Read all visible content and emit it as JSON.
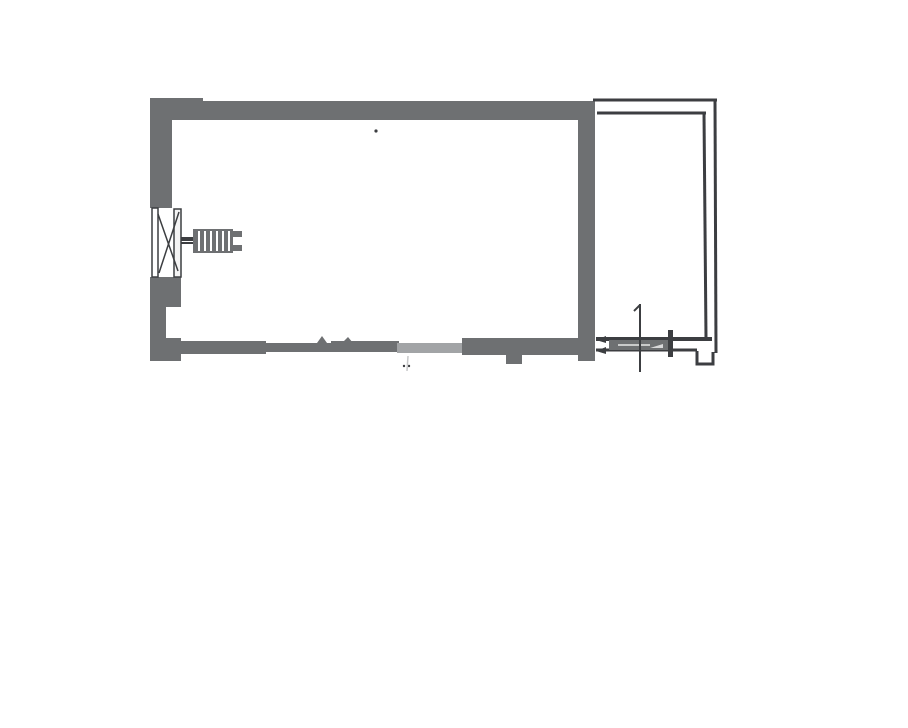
{
  "page": {
    "width": 908,
    "height": 728,
    "background": "#ffffff"
  },
  "drawing": {
    "kind": "scanned floor plan",
    "colors": {
      "wall": "#6e7072",
      "wall_faded": "#a2a4a6",
      "line": "#3c3e41",
      "paper": "#ffffff",
      "highlight": "#f4f4f4",
      "faint": "#c8c9ca"
    },
    "viewbox": "0 0 908 728",
    "elements": [
      {
        "name": "main-room-top-and-left-wall",
        "type": "path",
        "attrs": {
          "d": "M150 98 H203 V101 H594 V120 H172 V208 H150 Z",
          "fill": "@wall"
        }
      },
      {
        "name": "main-room-right-wall",
        "type": "rect",
        "attrs": {
          "x": 578,
          "y": 101,
          "width": 17,
          "height": 260,
          "fill": "@wall"
        }
      },
      {
        "name": "left-wall-below-window",
        "type": "path",
        "attrs": {
          "d": "M150 277 H181 V307 H166 V339 H150 Z",
          "fill": "@wall"
        }
      },
      {
        "name": "bottom-wall-left-segment",
        "type": "path",
        "attrs": {
          "d": "M150 338 H181 V341 H266 V354 H181 V361 H150 Z",
          "fill": "@wall"
        }
      },
      {
        "name": "bottom-wall-middle-segment",
        "type": "path",
        "attrs": {
          "d": "M266 343 H331 V341 H399 V352 H266 Z",
          "fill": "@wall"
        }
      },
      {
        "name": "bottom-wall-tick-1",
        "type": "path",
        "attrs": {
          "d": "M317 343 L322 336 L327 343 Z",
          "fill": "@wall"
        }
      },
      {
        "name": "bottom-wall-tick-2",
        "type": "path",
        "attrs": {
          "d": "M342 343 L348 337 L353 343 Z",
          "fill": "@wall"
        }
      },
      {
        "name": "bottom-wall-faded-segment",
        "type": "rect",
        "attrs": {
          "x": 397,
          "y": 343,
          "width": 68,
          "height": 10,
          "fill": "@wall_faded"
        }
      },
      {
        "name": "bottom-wall-right-segment",
        "type": "path",
        "attrs": {
          "d": "M462 338 H578 V355 H522 V364 H506 V355 H462 Z",
          "fill": "@wall"
        }
      },
      {
        "name": "balcony-outer-top-line",
        "type": "line",
        "attrs": {
          "x1": 593,
          "y1": 100,
          "x2": 717,
          "y2": 100,
          "stroke": "@line",
          "stroke-width": 3
        }
      },
      {
        "name": "balcony-inner-top-line",
        "type": "line",
        "attrs": {
          "x1": 597,
          "y1": 113,
          "x2": 706,
          "y2": 113,
          "stroke": "@line",
          "stroke-width": 3
        }
      },
      {
        "name": "balcony-inner-right-line",
        "type": "line",
        "attrs": {
          "x1": 704,
          "y1": 113,
          "x2": 706,
          "y2": 338,
          "stroke": "@line",
          "stroke-width": 3
        }
      },
      {
        "name": "balcony-outer-right-line",
        "type": "line",
        "attrs": {
          "x1": 715,
          "y1": 100,
          "x2": 716,
          "y2": 353,
          "stroke": "@line",
          "stroke-width": 3
        }
      },
      {
        "name": "balcony-bottom-outer-line",
        "type": "line",
        "attrs": {
          "x1": 596,
          "y1": 339,
          "x2": 712,
          "y2": 339,
          "stroke": "@line",
          "stroke-width": 4
        }
      },
      {
        "name": "balcony-bottom-inner-line",
        "type": "line",
        "attrs": {
          "x1": 596,
          "y1": 350,
          "x2": 697,
          "y2": 350,
          "stroke": "@line",
          "stroke-width": 3
        }
      },
      {
        "name": "balcony-corner-notch",
        "type": "path",
        "attrs": {
          "d": "M697 351 V364 H713 V352",
          "fill": "none",
          "stroke": "@line",
          "stroke-width": 3
        }
      },
      {
        "name": "door-leaf",
        "type": "rect",
        "attrs": {
          "x": 609,
          "y": 340,
          "width": 62,
          "height": 10,
          "fill": "@wall"
        }
      },
      {
        "name": "door-leaf-highlight",
        "type": "line",
        "attrs": {
          "x1": 618,
          "y1": 345,
          "x2": 650,
          "y2": 345,
          "stroke": "#fafafa",
          "stroke-width": 2,
          "opacity": 0.65
        }
      },
      {
        "name": "door-leaf-wedge",
        "type": "path",
        "attrs": {
          "d": "M650 348 L663 344 L663 348 Z",
          "fill": "#f2f2f2",
          "opacity": 0.8
        }
      },
      {
        "name": "door-stop-bar",
        "type": "rect",
        "attrs": {
          "x": 668,
          "y": 330,
          "width": 5,
          "height": 27,
          "fill": "@line"
        }
      },
      {
        "name": "door-axis-line",
        "type": "line",
        "attrs": {
          "x1": 640,
          "y1": 304,
          "x2": 640,
          "y2": 372,
          "stroke": "@line",
          "stroke-width": 2
        }
      },
      {
        "name": "door-axis-arrow",
        "type": "path",
        "attrs": {
          "d": "M640 305 L634 311",
          "fill": "none",
          "stroke": "@line",
          "stroke-width": 2
        }
      },
      {
        "name": "door-arrow-upper",
        "type": "path",
        "attrs": {
          "d": "M606 336 L596 340 L606 343 Z",
          "fill": "@line"
        }
      },
      {
        "name": "door-arrow-lower",
        "type": "path",
        "attrs": {
          "d": "M606 347 L596 351 L606 354 Z",
          "fill": "@line"
        }
      },
      {
        "name": "window-outer-bar",
        "type": "rect",
        "attrs": {
          "x": 152,
          "y": 208,
          "width": 6,
          "height": 69,
          "fill": "#ffffff",
          "stroke": "@line",
          "stroke-width": 1.5
        }
      },
      {
        "name": "window-inner-bar",
        "type": "rect",
        "attrs": {
          "x": 174,
          "y": 209,
          "width": 7,
          "height": 68,
          "fill": "@highlight",
          "stroke": "@line",
          "stroke-width": 1.5
        }
      },
      {
        "name": "window-diagonal-1",
        "type": "path",
        "attrs": {
          "d": "M179 212 L159 273",
          "fill": "none",
          "stroke": "@line",
          "stroke-width": 1.5
        }
      },
      {
        "name": "window-diagonal-2",
        "type": "path",
        "attrs": {
          "d": "M158 214 L178 271",
          "fill": "none",
          "stroke": "@line",
          "stroke-width": 1.5
        }
      },
      {
        "name": "window-sill-line-1",
        "type": "line",
        "attrs": {
          "x1": 181,
          "y1": 238,
          "x2": 194,
          "y2": 238,
          "stroke": "@line",
          "stroke-width": 2
        }
      },
      {
        "name": "window-sill-line-2",
        "type": "line",
        "attrs": {
          "x1": 181,
          "y1": 243,
          "x2": 194,
          "y2": 243,
          "stroke": "@line",
          "stroke-width": 2
        }
      },
      {
        "name": "radiator-icon-body",
        "type": "rect",
        "attrs": {
          "x": 193,
          "y": 229,
          "width": 40,
          "height": 24,
          "fill": "@wall"
        }
      },
      {
        "name": "radiator-icon-stripes",
        "type": "path",
        "attrs": {
          "d": "M199 231 V251 M205 231 V251 M211 231 V251 M217 231 V251 M223 231 V251 M229 231 V251",
          "fill": "none",
          "stroke": "#ffffff",
          "stroke-width": 2
        }
      },
      {
        "name": "radiator-icon-notch-top",
        "type": "rect",
        "attrs": {
          "x": 231,
          "y": 231,
          "width": 11,
          "height": 6,
          "fill": "@wall"
        }
      },
      {
        "name": "radiator-icon-notch-bottom",
        "type": "rect",
        "attrs": {
          "x": 231,
          "y": 245,
          "width": 11,
          "height": 6,
          "fill": "@wall"
        }
      },
      {
        "name": "radiator-connector-line",
        "type": "line",
        "attrs": {
          "x1": 181,
          "y1": 240,
          "x2": 193,
          "y2": 240,
          "stroke": "@line",
          "stroke-width": 2
        }
      },
      {
        "name": "scan-speck",
        "type": "circle",
        "attrs": {
          "cx": 376,
          "cy": 131,
          "r": 1.6,
          "fill": "@line"
        }
      },
      {
        "name": "scan-dot-1",
        "type": "circle",
        "attrs": {
          "cx": 404,
          "cy": 366,
          "r": 1.2,
          "fill": "@line"
        }
      },
      {
        "name": "scan-dot-2",
        "type": "circle",
        "attrs": {
          "cx": 409,
          "cy": 366,
          "r": 1.2,
          "fill": "@line"
        }
      },
      {
        "name": "scan-faint-streak",
        "type": "line",
        "attrs": {
          "x1": 408,
          "y1": 356,
          "x2": 407,
          "y2": 371,
          "stroke": "@faint",
          "stroke-width": 1.5
        }
      }
    ]
  }
}
